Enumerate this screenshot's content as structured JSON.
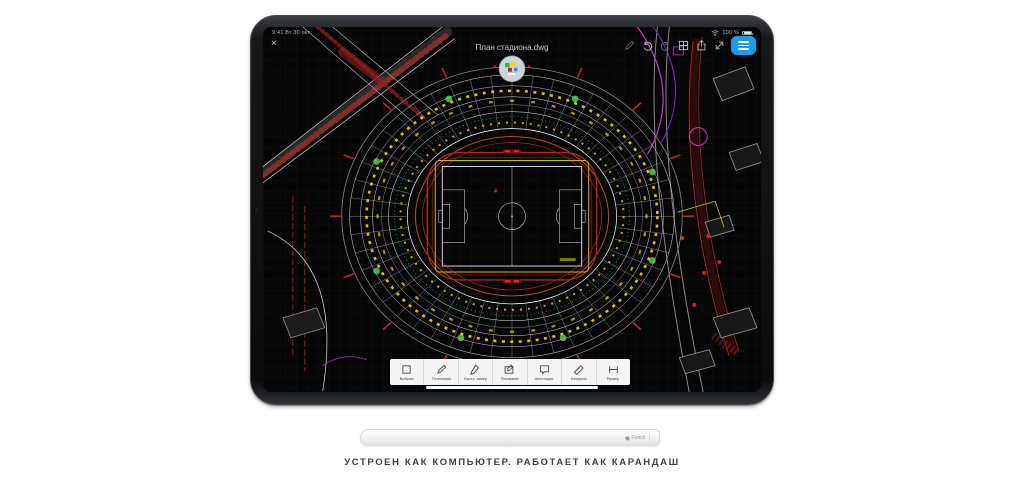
{
  "page": {
    "caption": "УСТРОЕН КАК КОМПЬЮТЕР. РАБОТАЕТ КАК КАРАНДАШ"
  },
  "ipad": {
    "status_bar": {
      "datetime": "9:41 Вт 30 окт.",
      "battery": "100 %"
    },
    "title_bar": {
      "title": "План стадиона.dwg",
      "close_glyph": "×",
      "icon_names": [
        "marker-icon",
        "undo-icon",
        "redo-icon",
        "grid-icon",
        "share-icon",
        "resize-icon",
        "layers-icon"
      ]
    },
    "toolbar": {
      "tools": [
        {
          "label": "Выбрать"
        },
        {
          "label": "Полилиния"
        },
        {
          "label": "Быстр. замер"
        },
        {
          "label": "Рисование"
        },
        {
          "label": "Аннотация"
        },
        {
          "label": "Измерить"
        },
        {
          "label": "Размер"
        }
      ]
    }
  },
  "pencil": {
    "label": "Pencil"
  },
  "colors": {
    "accent_blue": "#1e9ceb",
    "cad_red": "#c02020",
    "cad_yellow": "#ffd400",
    "cad_cyan": "#00cccc",
    "cad_magenta": "#c03cc0",
    "cad_green": "#46d24e"
  }
}
